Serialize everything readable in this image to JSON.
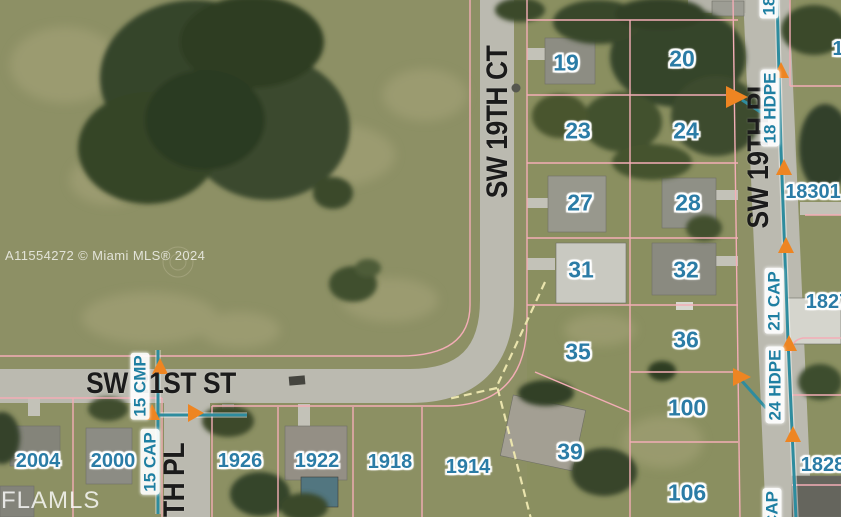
{
  "map": {
    "watermarks": {
      "listing_id": "A11554272 © Miami MLS® 2024",
      "mls": "FLAMLS"
    },
    "streets": {
      "sw19ct": "SW 19TH CT",
      "sw19pl": "SW 19TH PL",
      "sw21st": "SW 21ST ST",
      "sw20pl_partial": "TH PL"
    },
    "lots": {
      "l19": "19",
      "l20": "20",
      "l23": "23",
      "l24": "24",
      "l27": "27",
      "l28": "28",
      "l31": "31",
      "l32": "32",
      "l35": "35",
      "l36": "36",
      "l39": "39",
      "l100": "100",
      "l106": "106"
    },
    "addresses": {
      "a2004": "2004",
      "a2000": "2000",
      "a1926": "1926",
      "a1922": "1922",
      "a1918": "1918",
      "a1914": "1914",
      "a18301": "18301",
      "a1827": "1827",
      "a1828": "1828",
      "a1_partial": "1"
    },
    "utilities": {
      "u15cmp": "15 CMP",
      "u15cap": "15 CAP",
      "u18hdpe": "18 HDPE",
      "u21cap": "21 CAP",
      "u24hdpe": "24 HDPE",
      "ucap_partial": "CAP",
      "u18_partial": "18"
    },
    "colors": {
      "lot_number": "#2b7ca6",
      "parcel_line": "#f3adb6",
      "pipe_line": "#2e8c9e",
      "arrow": "#ee8522",
      "street_label": "#1b1b1b",
      "highlight_dash": "#eae4ad",
      "grass": "#8d9065",
      "pavement": "#bbbab0"
    }
  }
}
